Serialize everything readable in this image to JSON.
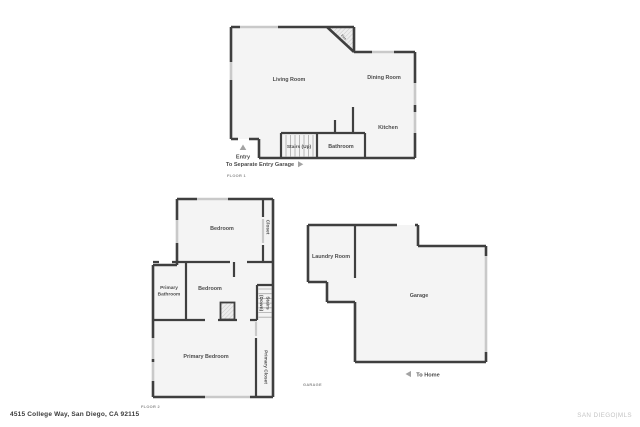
{
  "page": {
    "background": "#ffffff",
    "address": "4515 College Way, San Diego, CA 92115",
    "watermark": "SAN DIEGO|MLS"
  },
  "colors": {
    "wall": "#3f3f3f",
    "room_fill": "#f4f4f4",
    "window": "#c9c9c9",
    "label_text": "#4d4d4d",
    "caption_text": "#8d8d8d",
    "arrow": "#a3a3a3"
  },
  "floor1": {
    "caption": "FLOOR 1",
    "rooms": {
      "living_room": "Living Room",
      "dining_room": "Dining Room",
      "kitchen": "Kitchen",
      "bathroom": "Bathroom",
      "stairs_up": "Stairs (Up)",
      "fireplace": "Fire"
    },
    "annotations": {
      "entry": "Entry",
      "to_separate_entry_garage": "To Separate Entry Garage"
    },
    "icons": {
      "entry_arrow": "triangle-up-icon",
      "garage_arrow": "triangle-right-icon"
    }
  },
  "floor2": {
    "caption": "FLOOR 2",
    "rooms": {
      "bedroom_top": "Bedroom",
      "closet": "Closet",
      "primary_bathroom": [
        "Primary",
        "Bathroom"
      ],
      "bedroom_middle": "Bedroom",
      "stairs_down": [
        "Stairs",
        "(Down)"
      ],
      "primary_bedroom": "Primary Bedroom",
      "primary_closet": "Primary Closet"
    }
  },
  "garage_plan": {
    "caption": "GARAGE",
    "rooms": {
      "laundry_room": "Laundry Room",
      "garage": "Garage"
    },
    "annotations": {
      "to_home": "To Home"
    },
    "icons": {
      "home_arrow": "triangle-left-icon"
    }
  }
}
